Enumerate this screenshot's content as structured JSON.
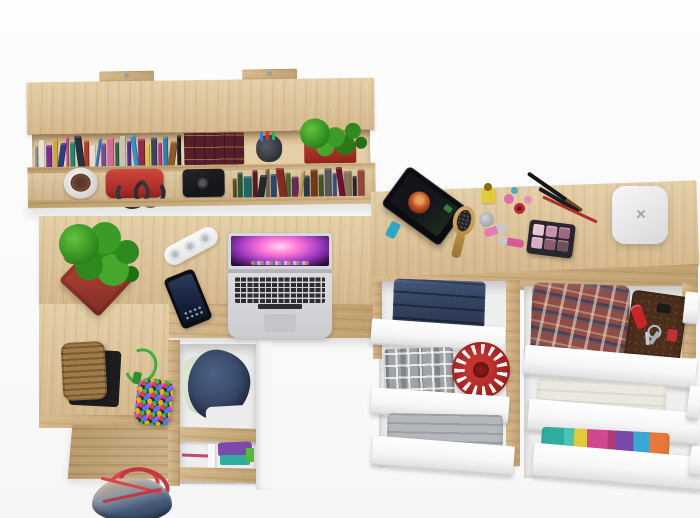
{
  "image_type": "3d-product-render-top-view",
  "subject": "Home office set in oak and white: wall shelf with books, L-shaped desk with laptop, chest of drawers with open drawers of folded clothes",
  "colors": {
    "bg": "#fbfbfb",
    "wood": "#d5b88c",
    "wood_light": "#e4cfa7",
    "wood_dark": "#bf9f6f",
    "white_front": "#f6f6f6",
    "interior": "#eeeeee",
    "denim": "#33425f",
    "denim_light": "#4c6185",
    "plaid_gray": "#9fa2a6",
    "hat_red": "#a32420",
    "plaid_red": "#8f4d46",
    "wallet_brown": "#4b2e1b",
    "towel": "#ebe8df",
    "teal": "#2fae9f",
    "purple": "#7b49a9",
    "pink": "#d1488f",
    "yellow": "#e3ca39",
    "plant_green": "#3a9423",
    "pot_red": "#b5453c",
    "bag_red": "#d8434c",
    "laptop_silver": "#d7d8db",
    "key": "#2c2d31",
    "router_white": "#ececee",
    "cork": "#96713f",
    "camera_black": "#17181c"
  },
  "books": {
    "shelf_top": [
      "#8a8f96",
      "#e6e2da",
      "#7a2d8e",
      "#caa83a",
      "#2c3e82",
      "#c94f7c",
      "#1f8a70",
      "#27303f",
      "#b23a2f",
      "#e0ddd5",
      "#3a7ac9",
      "#7a4a9e",
      "#d06a9a",
      "#2a6a4a",
      "#c8c2b8",
      "#5a2d8e",
      "#3692c4",
      "#8e2d48",
      "#d9c23a",
      "#34495e",
      "#b43a86",
      "#2980b9",
      "#8e5a2c",
      "#1a1d24"
    ],
    "shelf_bottom": [
      "#6a4a26",
      "#2e5a3a",
      "#1d6a6a",
      "#5a1d2a",
      "#23272e",
      "#7a6a4a",
      "#2a4a7a",
      "#8a2a22",
      "#4a6a2a",
      "#6a2a5a",
      "#caa25a",
      "#23404e",
      "#7a3a1e",
      "#405a28",
      "#5a5a62",
      "#305a8a",
      "#771133",
      "#8a7a5a",
      "#2a2a32",
      "#9a4a3a"
    ]
  },
  "cosmetics": {
    "palette_pans": [
      "#e8c6d4",
      "#c890ac",
      "#a06880",
      "#d8aec6",
      "#8a5a70",
      "#6e5058"
    ]
  },
  "scene": {
    "wall_shelf": {
      "items": [
        "paperback-books",
        "encyclopedia-set",
        "pen-cup",
        "red-planter-with-plant",
        "white-cup-plant",
        "red-handbag",
        "black-camera",
        "hardcover-books"
      ]
    },
    "desk": {
      "items": [
        "succulent-in-red-pot",
        "white-power-strip",
        "black-smartphone",
        "silver-laptop-open",
        "cork-basket",
        "beaded-toy-green-cord"
      ],
      "drawers": [
        "open-drawer-denim-and-linen",
        "open-drawer-purple-teal-clothes"
      ]
    },
    "chest": {
      "top_items": [
        "tablet-on-stand",
        "wooden-hairbrush",
        "nail-polishes-lipsticks-brushes",
        "eyeshadow-palette",
        "white-router-box"
      ],
      "left_drawers": [
        "folded-jeans",
        "gray-plaid-shirt-and-red-knit-hat",
        "gray-folded-clothes"
      ],
      "right_drawers": [
        "red-plaid-shirt-wallet-knife-keys",
        "white-towel",
        "colorful-folded-clothes"
      ]
    },
    "floor_items": [
      "denim-tote-bag-red-handles"
    ]
  }
}
